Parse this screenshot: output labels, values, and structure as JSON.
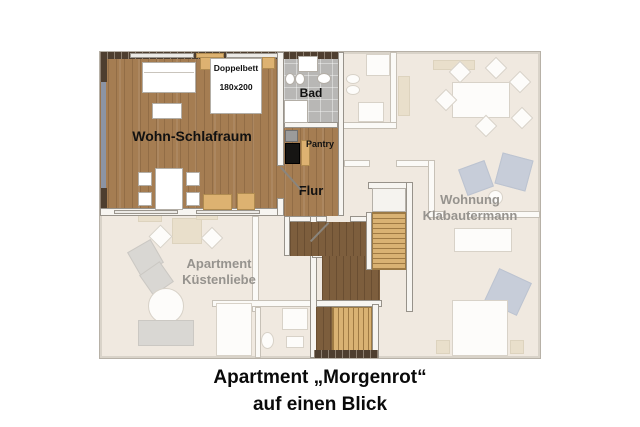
{
  "title": {
    "line1": "Apartment „Morgenrot“",
    "line2": "auf einen Blick"
  },
  "rooms": {
    "living_room": "Wohn-Schlafraum",
    "bed": {
      "line1": "Doppelbett",
      "line2": "180x200"
    },
    "bathroom": "Bad",
    "pantry": "Pantry",
    "hallway": "Flur"
  },
  "neighboring_units": {
    "right": {
      "line1": "Wohnung",
      "line2": "Klabautermann"
    },
    "left": {
      "line1": "Apartment",
      "line2": "Küstenliebe"
    }
  },
  "colors": {
    "wood": "#a57d52",
    "wood_dark": "#7d5e3d",
    "stairs": "#d9b273",
    "tile": "#b8b7b5",
    "brick": "#4e3e2f",
    "window_strip": "#8c94a4",
    "faded_floor": "#f0e9e0",
    "faded_text": "#96938e",
    "tan": "#ddb271"
  }
}
